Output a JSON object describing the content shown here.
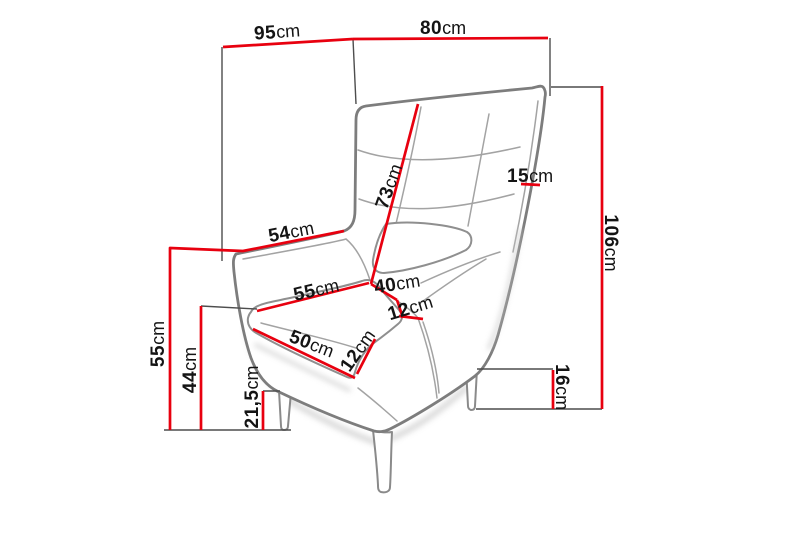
{
  "diagram": {
    "subject": "wingback-armchair-dimension-drawing",
    "unit": "cm",
    "colors": {
      "dimension_line": "#e8000f",
      "chair_outline": "#7d7d7d",
      "helper_line": "#4d4d4d",
      "label_text": "#141414",
      "background": "#ffffff"
    },
    "labels": {
      "overall_depth": {
        "value": "95",
        "unit": "cm"
      },
      "overall_width": {
        "value": "80",
        "unit": "cm"
      },
      "wing_edge_length": {
        "value": "54",
        "unit": "cm"
      },
      "backrest_height": {
        "value": "73",
        "unit": "cm"
      },
      "side_thickness": {
        "value": "15",
        "unit": "cm"
      },
      "total_height": {
        "value": "106",
        "unit": "cm"
      },
      "seat_width_back": {
        "value": "55",
        "unit": "cm"
      },
      "seat_depth": {
        "value": "40",
        "unit": "cm"
      },
      "cushion_thickness_side": {
        "value": "12",
        "unit": "cm"
      },
      "seat_width_front": {
        "value": "50",
        "unit": "cm"
      },
      "cushion_thickness_front": {
        "value": "12",
        "unit": "cm"
      },
      "wing_height": {
        "value": "55",
        "unit": "cm"
      },
      "seat_top_height": {
        "value": "44",
        "unit": "cm"
      },
      "under_seat_clearance": {
        "value": "21,5",
        "unit": "cm"
      },
      "leg_height": {
        "value": "16",
        "unit": "cm"
      }
    }
  }
}
